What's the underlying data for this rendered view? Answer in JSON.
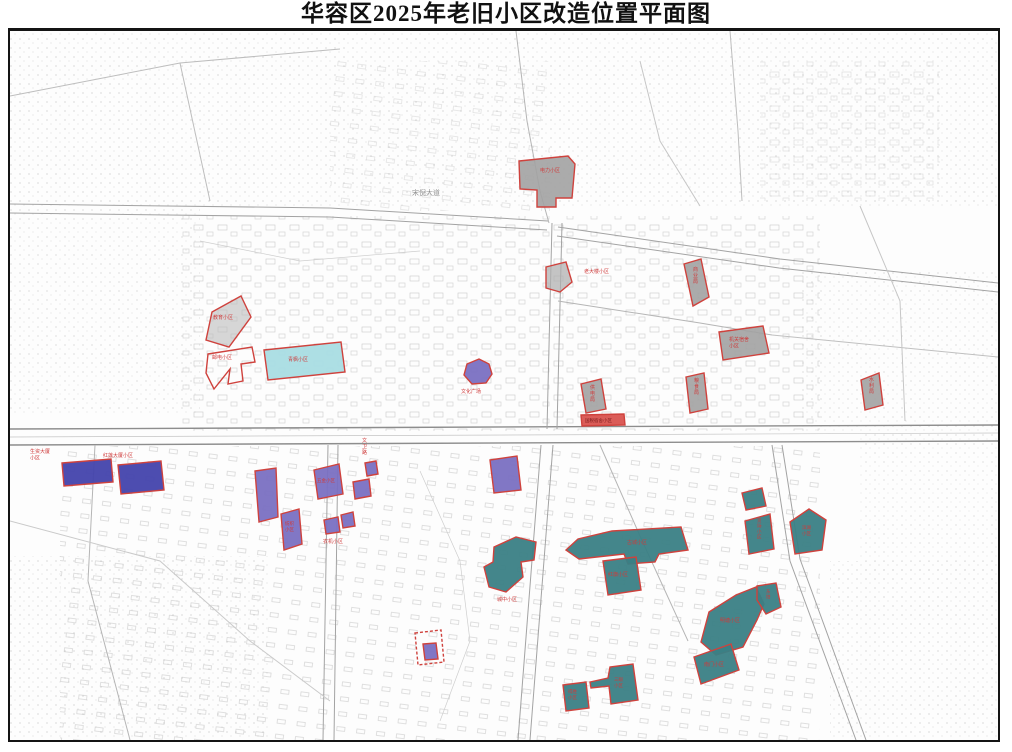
{
  "title": "华容区2025年老旧小区改造位置平面图",
  "colors": {
    "border_red": "#cf423d",
    "gray_fill": "#a2a2a2",
    "teal_fill": "#3a7f85",
    "purple_fill": "#7a70c2",
    "darkblue_fill": "#4343ac",
    "cyan_fill": "#a9dde3",
    "label_red": "#cf3b3b",
    "road_gray": "#a3a3a3"
  },
  "map": {
    "road_labels": [
      {
        "text": "宋倪大道",
        "x": 412,
        "y": 194,
        "size": 7,
        "color": "#8f8f8f",
        "vertical": false
      },
      {
        "text": "文卫路",
        "x": 362,
        "y": 441,
        "size": 5,
        "color": "#cf3b3b",
        "vertical": true
      }
    ],
    "areas": [
      {
        "name": "电力小区",
        "points": "519,160 568,155 575,163 572,197 556,197 556,206 537,206 537,189 520,188",
        "fill": "#a2a2a2",
        "opacity": 0.9,
        "label": {
          "text": "电力小区",
          "x": 540,
          "y": 171,
          "size": 5,
          "color": "#cf3b3b"
        }
      },
      {
        "name": "老大楼小区",
        "points": "546,266 566,261 572,281 560,291 546,287",
        "fill": "#b0b0b0",
        "opacity": 0.75,
        "label": {
          "text": "老大楼小区",
          "x": 584,
          "y": 272,
          "size": 5,
          "color": "#cf3b3b"
        }
      },
      {
        "name": "商业局小区",
        "points": "684,263 701,258 709,296 693,305",
        "fill": "#a2a2a2",
        "opacity": 0.9,
        "label": {
          "text": "商业局",
          "x": 693,
          "y": 270,
          "size": 5,
          "color": "#cf3b3b",
          "vertical": true
        }
      },
      {
        "name": "机关宿舍小区",
        "points": "719,331 763,325 769,352 723,359",
        "fill": "#a2a2a2",
        "opacity": 0.9,
        "label": {
          "lines": [
            "机关宿舍",
            "小区"
          ],
          "x": 729,
          "y": 340,
          "size": 5,
          "color": "#cf3b3b"
        }
      },
      {
        "name": "粮食局小区",
        "points": "686,376 704,372 708,408 690,412",
        "fill": "#a2a2a2",
        "opacity": 0.9,
        "label": {
          "text": "粮食局",
          "x": 694,
          "y": 381,
          "size": 5,
          "color": "#cf3b3b",
          "vertical": true
        }
      },
      {
        "name": "水利局小区",
        "points": "861,379 879,372 883,404 865,409",
        "fill": "#a2a2a2",
        "opacity": 0.9,
        "label": {
          "text": "水利局",
          "x": 869,
          "y": 380,
          "size": 5,
          "color": "#cf3b3b",
          "vertical": true
        }
      },
      {
        "name": "教育小区",
        "points": "212,311 241,295 251,316 229,346 206,339",
        "fill": "#bdbdbd",
        "opacity": 0.6,
        "label": {
          "text": "教育小区",
          "x": 213,
          "y": 318,
          "size": 5,
          "color": "#cf3b3b"
        }
      },
      {
        "name": "邮电小区",
        "points": "208,353 252,346 255,361 241,363 243,380 228,383 230,368 214,388 206,372",
        "fill": "none",
        "opacity": 1,
        "label": {
          "text": "邮电小区",
          "x": 212,
          "y": 358,
          "size": 5,
          "color": "#cf3b3b"
        }
      },
      {
        "name": "青枫小区",
        "points": "264,349 341,341 345,371 268,379",
        "fill": "#a9dde3",
        "opacity": 0.95,
        "label": {
          "text": "青枫小区",
          "x": 288,
          "y": 360,
          "size": 5,
          "color": "#cf3b3b"
        }
      },
      {
        "name": "文化广场",
        "points": "467,363 479,358 489,363 492,373 486,382 472,383 464,374",
        "fill": "#7a70c2",
        "opacity": 0.95,
        "label": {
          "text": "文化广场",
          "x": 461,
          "y": 392,
          "size": 5,
          "color": "#cf3b3b"
        }
      },
      {
        "name": "供电局小区",
        "points": "581,383 601,378 606,408 586,412",
        "fill": "#a2a2a2",
        "opacity": 0.9,
        "label": {
          "text": "供电局",
          "x": 590,
          "y": 388,
          "size": 5,
          "color": "#cf3b3b",
          "vertical": true
        }
      },
      {
        "name": "国税宿舍小区",
        "points": "581,414 624,413 625,424 582,425",
        "fill": "#d9534f",
        "opacity": 0.95,
        "label": {
          "text": "国税宿舍小区",
          "x": 585,
          "y": 421,
          "size": 4.5,
          "color": "#7a1a1a"
        }
      },
      {
        "name": "小区-中部紫",
        "points": "490,459 517,455 521,489 494,492",
        "fill": "#7a70c2",
        "opacity": 0.95
      },
      {
        "name": "生资大厦小区",
        "points": "62,462 111,458 113,481 64,485",
        "fill": "#4343ac",
        "opacity": 0.95,
        "label": {
          "lines": [
            "生资大厦",
            "小区"
          ],
          "x": 30,
          "y": 452,
          "size": 5,
          "color": "#cf3b3b"
        }
      },
      {
        "name": "红莲大厦小区",
        "points": "118,464 161,460 164,489 121,493",
        "fill": "#4343ac",
        "opacity": 0.95,
        "label": {
          "text": "红莲大厦小区",
          "x": 103,
          "y": 456,
          "size": 5,
          "color": "#cf3b3b"
        }
      },
      {
        "name": "小区-纺织西",
        "points": "255,470 276,467 278,516 259,521",
        "fill": "#7a70c2",
        "opacity": 0.95
      },
      {
        "name": "纺织小区",
        "points": "281,513 299,508 302,543 284,549",
        "fill": "#7a70c2",
        "opacity": 0.95,
        "label": {
          "lines": [
            "纺织",
            "小区"
          ],
          "x": 285,
          "y": 524,
          "size": 4.5,
          "color": "#cf3b3b"
        }
      },
      {
        "name": "五金小区",
        "points": "314,469 339,463 343,493 318,498",
        "fill": "#7a70c2",
        "opacity": 0.95,
        "label": {
          "text": "五金小区",
          "x": 317,
          "y": 481,
          "size": 4.5,
          "color": "#cf3b3b"
        }
      },
      {
        "name": "小区-小紫1",
        "points": "353,481 369,478 371,495 355,498",
        "fill": "#7a70c2",
        "opacity": 0.95
      },
      {
        "name": "小区-小紫2",
        "points": "365,462 376,460 378,473 367,475",
        "fill": "#7a70c2",
        "opacity": 0.95
      },
      {
        "name": "农机小区-a",
        "points": "324,519 338,516 340,531 326,533",
        "fill": "#7a70c2",
        "opacity": 0.95
      },
      {
        "name": "农机小区-b",
        "points": "341,514 353,511 355,525 343,527",
        "fill": "#7a70c2",
        "opacity": 0.95,
        "label": {
          "text": "农机小区",
          "x": 323,
          "y": 542,
          "size": 5,
          "color": "#cf3b3b"
        }
      },
      {
        "name": "古城小区",
        "points": "566,549 578,538 612,530 681,526 688,549 659,553 655,561 628,563 624,553 579,558",
        "fill": "#3a7f85",
        "opacity": 0.95,
        "label": {
          "text": "古城小区",
          "x": 627,
          "y": 543,
          "size": 5,
          "color": "#cf3b3b"
        }
      },
      {
        "name": "红旗小区",
        "points": "603,560 636,556 641,589 608,594",
        "fill": "#3a7f85",
        "opacity": 0.95,
        "label": {
          "text": "红旗小区",
          "x": 608,
          "y": 575,
          "size": 5,
          "color": "#cf3b3b"
        }
      },
      {
        "name": "城中小区",
        "points": "494,546 516,536 536,541 534,559 521,561 523,576 506,591 489,586 484,566 493,561",
        "fill": "#3a7f85",
        "opacity": 0.95,
        "label": {
          "text": "城中小区",
          "x": 497,
          "y": 600,
          "size": 5,
          "color": "#cf3b3b"
        }
      },
      {
        "name": "小区-青绿北",
        "points": "742,492 762,487 766,505 746,509",
        "fill": "#3a7f85",
        "opacity": 0.95
      },
      {
        "name": "货场小区",
        "points": "745,520 770,513 774,548 749,553",
        "fill": "#3a7f85",
        "opacity": 0.95,
        "label": {
          "text": "货场小区",
          "x": 757,
          "y": 521,
          "size": 4.5,
          "color": "#cf3b3b",
          "vertical": true
        }
      },
      {
        "name": "滨湖小区",
        "points": "790,521 809,508 826,519 822,549 795,553",
        "fill": "#3a7f85",
        "opacity": 0.95,
        "label": {
          "lines": [
            "滨湖",
            "小区"
          ],
          "x": 802,
          "y": 528,
          "size": 4.5,
          "color": "#cf3b3b"
        }
      },
      {
        "name": "明塘小区",
        "points": "701,641 709,611 736,594 756,586 764,603 757,619 743,646 716,654",
        "fill": "#3a7f85",
        "opacity": 0.95,
        "label": {
          "text": "明塘小区",
          "x": 720,
          "y": 621,
          "size": 5,
          "color": "#cf3b3b"
        }
      },
      {
        "name": "东塔小区",
        "points": "757,585 776,582 781,606 766,613 757,599",
        "fill": "#3a7f85",
        "opacity": 0.95,
        "label": {
          "text": "东塔",
          "x": 766,
          "y": 592,
          "size": 4.5,
          "color": "#cf3b3b",
          "vertical": true
        }
      },
      {
        "name": "南门小区",
        "points": "694,656 731,643 739,669 701,683",
        "fill": "#3a7f85",
        "opacity": 0.95,
        "label": {
          "text": "南门小区",
          "x": 704,
          "y": 665,
          "size": 5,
          "color": "#cf3b3b"
        }
      },
      {
        "name": "得胜小区",
        "points": "563,684 586,681 589,707 566,710",
        "fill": "#3a7f85",
        "opacity": 0.95,
        "label": {
          "lines": [
            "得胜",
            "小区"
          ],
          "x": 568,
          "y": 692,
          "size": 4.5,
          "color": "#cf3b3b"
        }
      },
      {
        "name": "三眼小区",
        "points": "590,681 608,677 610,666 633,663 638,699 611,703 609,685 591,687",
        "fill": "#3a7f85",
        "opacity": 0.95,
        "label": {
          "lines": [
            "三眼",
            "小区"
          ],
          "x": 614,
          "y": 680,
          "size": 4.5,
          "color": "#cf3b3b"
        }
      },
      {
        "name": "小区-车站紫",
        "points": "423,643 436,642 438,658 425,659",
        "fill": "#7a70c2",
        "opacity": 0.95
      },
      {
        "name": "车站范围线",
        "points": "415,632 441,629 444,661 418,664",
        "fill": "none",
        "opacity": 1,
        "dash": true
      }
    ]
  }
}
